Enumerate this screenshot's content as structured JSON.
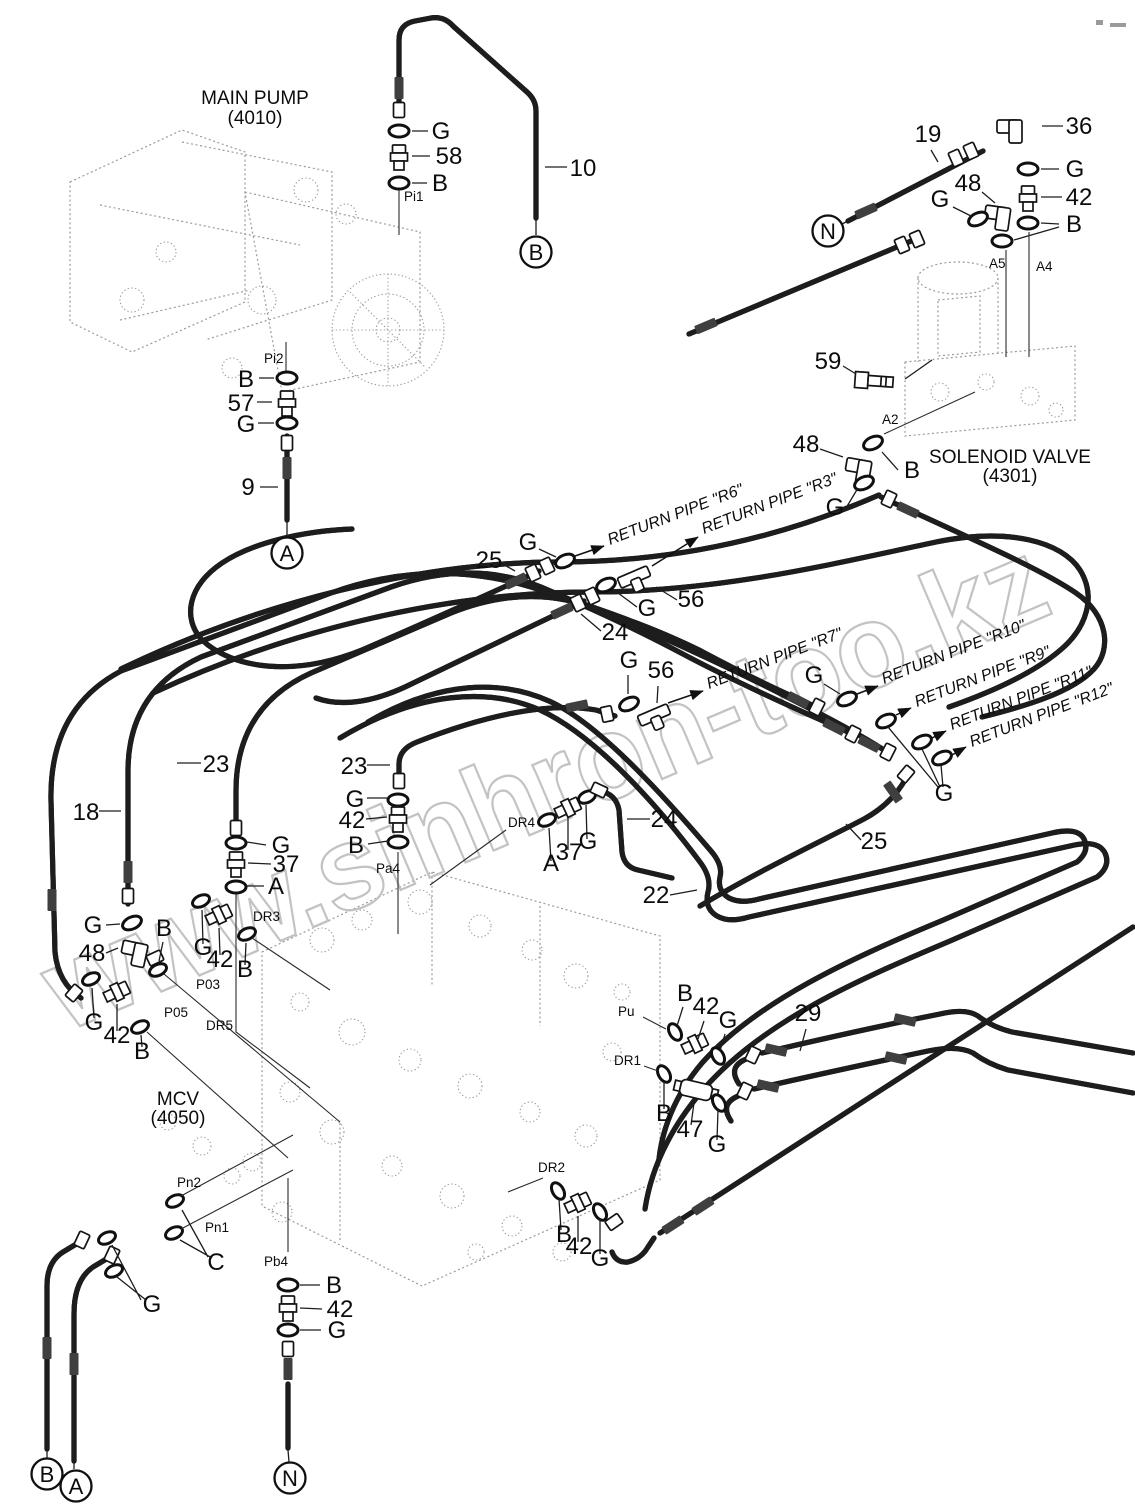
{
  "diagram": {
    "components": {
      "main_pump": {
        "name": "MAIN PUMP",
        "code": "(4010)"
      },
      "solenoid_valve": {
        "name": "SOLENOID VALVE",
        "code": "(4301)"
      },
      "mcv": {
        "name": "MCV",
        "code": "(4050)"
      }
    },
    "parts": {
      "p9": "9",
      "p10": "10",
      "p18": "18",
      "p19": "19",
      "p22": "22",
      "p23": "23",
      "p24": "24",
      "p25": "25",
      "p29": "29",
      "p36": "36",
      "p37": "37",
      "p42": "42",
      "p47": "47",
      "p48": "48",
      "p56": "56",
      "p57": "57",
      "p58": "58",
      "p59": "59"
    },
    "seals": {
      "a": "A",
      "b": "B",
      "c": "C",
      "g": "G"
    },
    "terminals": {
      "a": "A",
      "b": "B",
      "n": "N"
    },
    "ports": {
      "pi1": "Pi1",
      "pi2": "Pi2",
      "a2": "A2",
      "a4": "A4",
      "a5": "A5",
      "pa4": "Pa4",
      "p03": "P03",
      "p05": "P05",
      "pn1": "Pn1",
      "pn2": "Pn2",
      "pb4": "Pb4",
      "pu": "Pu",
      "dr1": "DR1",
      "dr2": "DR2",
      "dr3": "DR3",
      "dr4": "DR4",
      "dr5": "DR5"
    },
    "return_pipe_labels": {
      "r6": "RETURN PIPE \"R6\"",
      "r3": "RETURN PIPE \"R3\"",
      "r7": "RETURN PIPE \"R7\"",
      "r10": "RETURN PIPE \"R10\"",
      "r9": "RETURN PIPE \"R9\"",
      "r11": "RETURN PIPE \"R11\"",
      "r12": "RETURN PIPE \"R12\""
    },
    "watermark": "www.sinhron-too.kz"
  }
}
